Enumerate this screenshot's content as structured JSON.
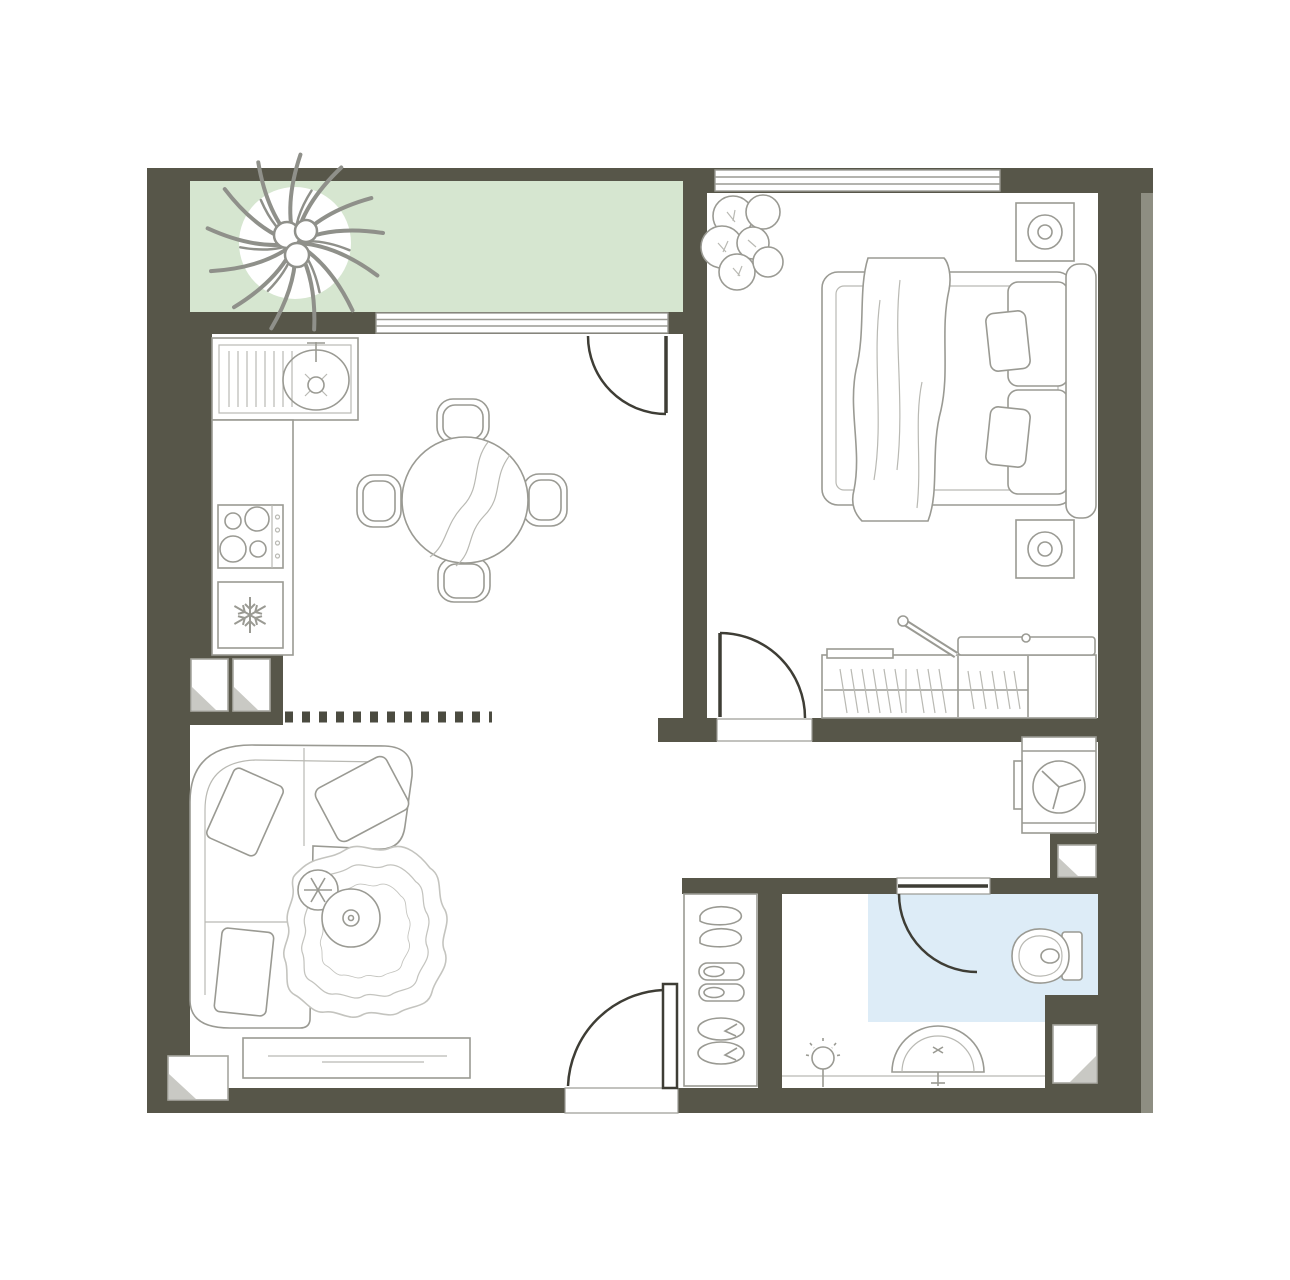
{
  "floor_plan": {
    "colors": {
      "wall": "#575649",
      "wall_edge": "#8e8e82",
      "balcony_floor": "#d6e6d0",
      "bathroom_floor": "#ddecf7",
      "outline": "#9a9a93",
      "outline_dark": "#3e3d35",
      "fold": "#c9c9c4",
      "paper": "#ffffff"
    },
    "rooms": [
      {
        "name": "balcony",
        "floor": "#d6e6d0"
      },
      {
        "name": "kitchen-dining",
        "floor": "#ffffff"
      },
      {
        "name": "bedroom",
        "floor": "#ffffff"
      },
      {
        "name": "living-room",
        "floor": "#ffffff"
      },
      {
        "name": "hallway",
        "floor": "#ffffff"
      },
      {
        "name": "bathroom",
        "floor": "#ddecf7"
      }
    ],
    "openings": {
      "windows": [
        "balcony-window",
        "bedroom-window"
      ],
      "doors": [
        "balcony-door",
        "bedroom-door",
        "bathroom-door",
        "entrance-door"
      ]
    },
    "furniture": {
      "balcony": [
        "potted-plant"
      ],
      "kitchen": [
        "kitchen-sink",
        "countertop",
        "cooktop-4-burners",
        "refrigerator"
      ],
      "dining": [
        "round-dining-table",
        "dining-chair",
        "dining-chair",
        "dining-chair",
        "dining-chair"
      ],
      "bedroom": [
        "plant",
        "double-bed",
        "blanket",
        "pillows",
        "headboard",
        "nightstand-lamp",
        "nightstand-lamp",
        "wardrobe-with-hangers",
        "ironing-board"
      ],
      "hallway": [
        "washing-machine",
        "shoe-cabinet",
        "shoes",
        "slippers",
        "flip-flops"
      ],
      "bathroom": [
        "toilet",
        "washbasin",
        "wall-lamp"
      ],
      "living": [
        "corner-sofa",
        "sofa-pillows",
        "area-rug",
        "coffee-table-small",
        "coffee-table-large",
        "tv-stand"
      ],
      "service": [
        "vent-shaft",
        "vent-shaft",
        "vent-shaft",
        "vent-shaft",
        "vent-shaft"
      ]
    }
  }
}
